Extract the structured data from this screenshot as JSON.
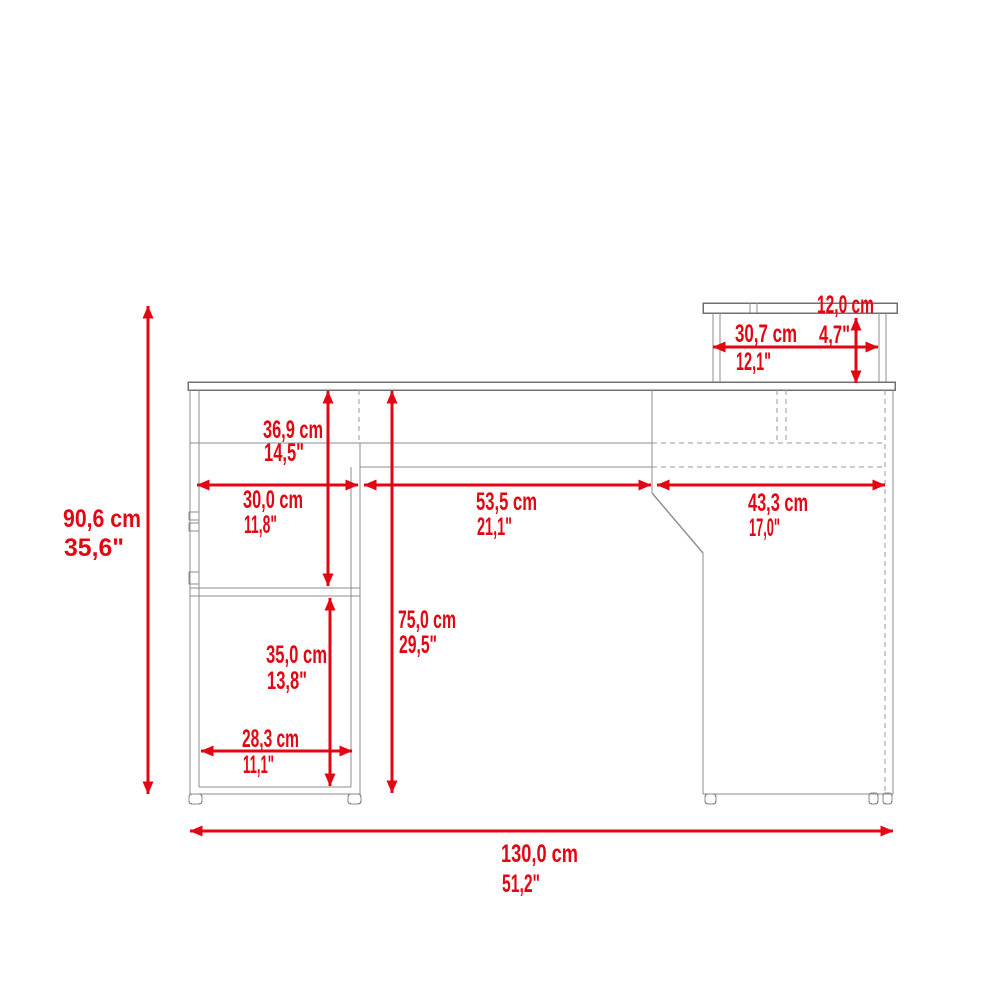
{
  "diagram": {
    "subject": "l-shaped-desk-with-hutch-dimension-drawing",
    "accent_color": "#e30613",
    "outline_color": "#8c8c8c",
    "background_color": "#ffffff"
  },
  "dimensions": {
    "overall_height": {
      "cm": "90,6 cm",
      "inches": "35,6\""
    },
    "hutch_height": {
      "cm": "12,0 cm",
      "inches": "4,7\""
    },
    "hutch_width": {
      "cm": "30,7 cm",
      "inches": "12,1\""
    },
    "desktop_to_shelf": {
      "cm": "36,9 cm",
      "inches": "14,5\""
    },
    "pedestal_width": {
      "cm": "30,0 cm",
      "inches": "11,8\""
    },
    "kneehole_width": {
      "cm": "53,5 cm",
      "inches": "21,1\""
    },
    "right_return_width": {
      "cm": "43,3 cm",
      "inches": "17,0\""
    },
    "desk_height": {
      "cm": "75,0 cm",
      "inches": "29,5\""
    },
    "compartment_height": {
      "cm": "35,0 cm",
      "inches": "13,8\""
    },
    "compartment_width": {
      "cm": "28,3 cm",
      "inches": "11,1\""
    },
    "overall_width": {
      "cm": "130,0 cm",
      "inches": "51,2\""
    }
  }
}
